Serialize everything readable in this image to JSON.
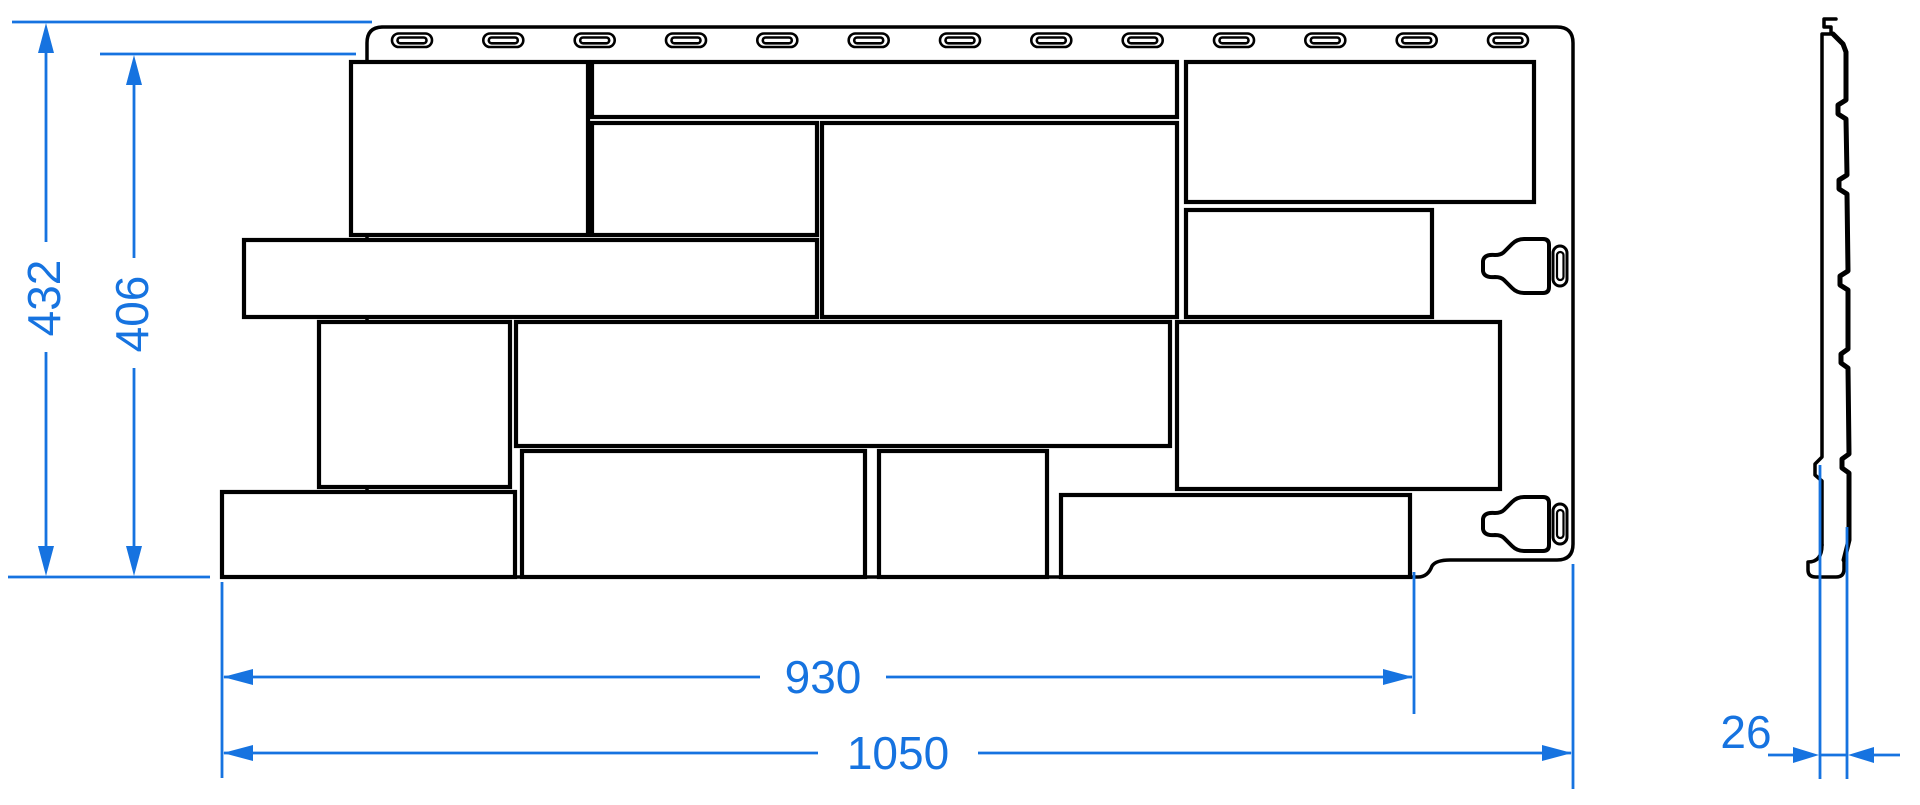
{
  "dimensions": {
    "overall_height": "432",
    "stone_field_height": "406",
    "stone_field_width": "930",
    "overall_width": "1050",
    "thickness": "26"
  },
  "colors": {
    "dimension_lines": "#1673e0",
    "outlines": "#000000",
    "background": "#ffffff"
  }
}
